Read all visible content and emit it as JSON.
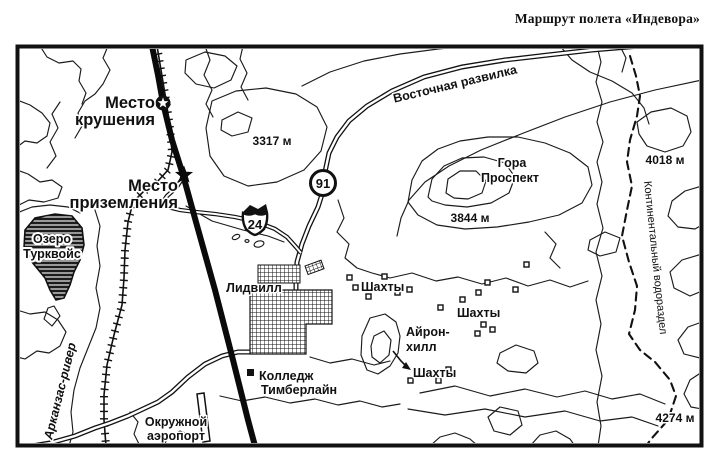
{
  "title": "Маршрут полета «Индевора»",
  "map": {
    "sites": {
      "crash": {
        "line1": "Место",
        "line2": "крушения"
      },
      "landing": {
        "line1": "Место",
        "line2": "приземления"
      }
    },
    "water": {
      "lake_line1": "Озеро",
      "lake_line2": "Турквойс",
      "river": "Арканзас-ривер",
      "east_fork": "Восточная развилка"
    },
    "places": {
      "town": "Лидвилл",
      "college_line1": "Колледж",
      "college_line2": "Тимберлайн",
      "airport_line1": "Окружной",
      "airport_line2": "аэропорт"
    },
    "terrain": {
      "mount_line1": "Гора",
      "mount_line2": "Проспект",
      "iron_hill_line1": "Айрон-",
      "iron_hill_line2": "хилл",
      "divide": "Континентальный водораздел",
      "elev_3317": "3317 м",
      "elev_3844": "3844 м",
      "elev_4018": "4018 м",
      "elev_4274": "4274 м"
    },
    "mines": {
      "nw": "Шахты",
      "e": "Шахты",
      "s": "Шахты"
    },
    "roads": {
      "hwy91": "91",
      "us24": "24"
    },
    "colors": {
      "ink": "#111111",
      "paper": "#ffffff"
    }
  }
}
